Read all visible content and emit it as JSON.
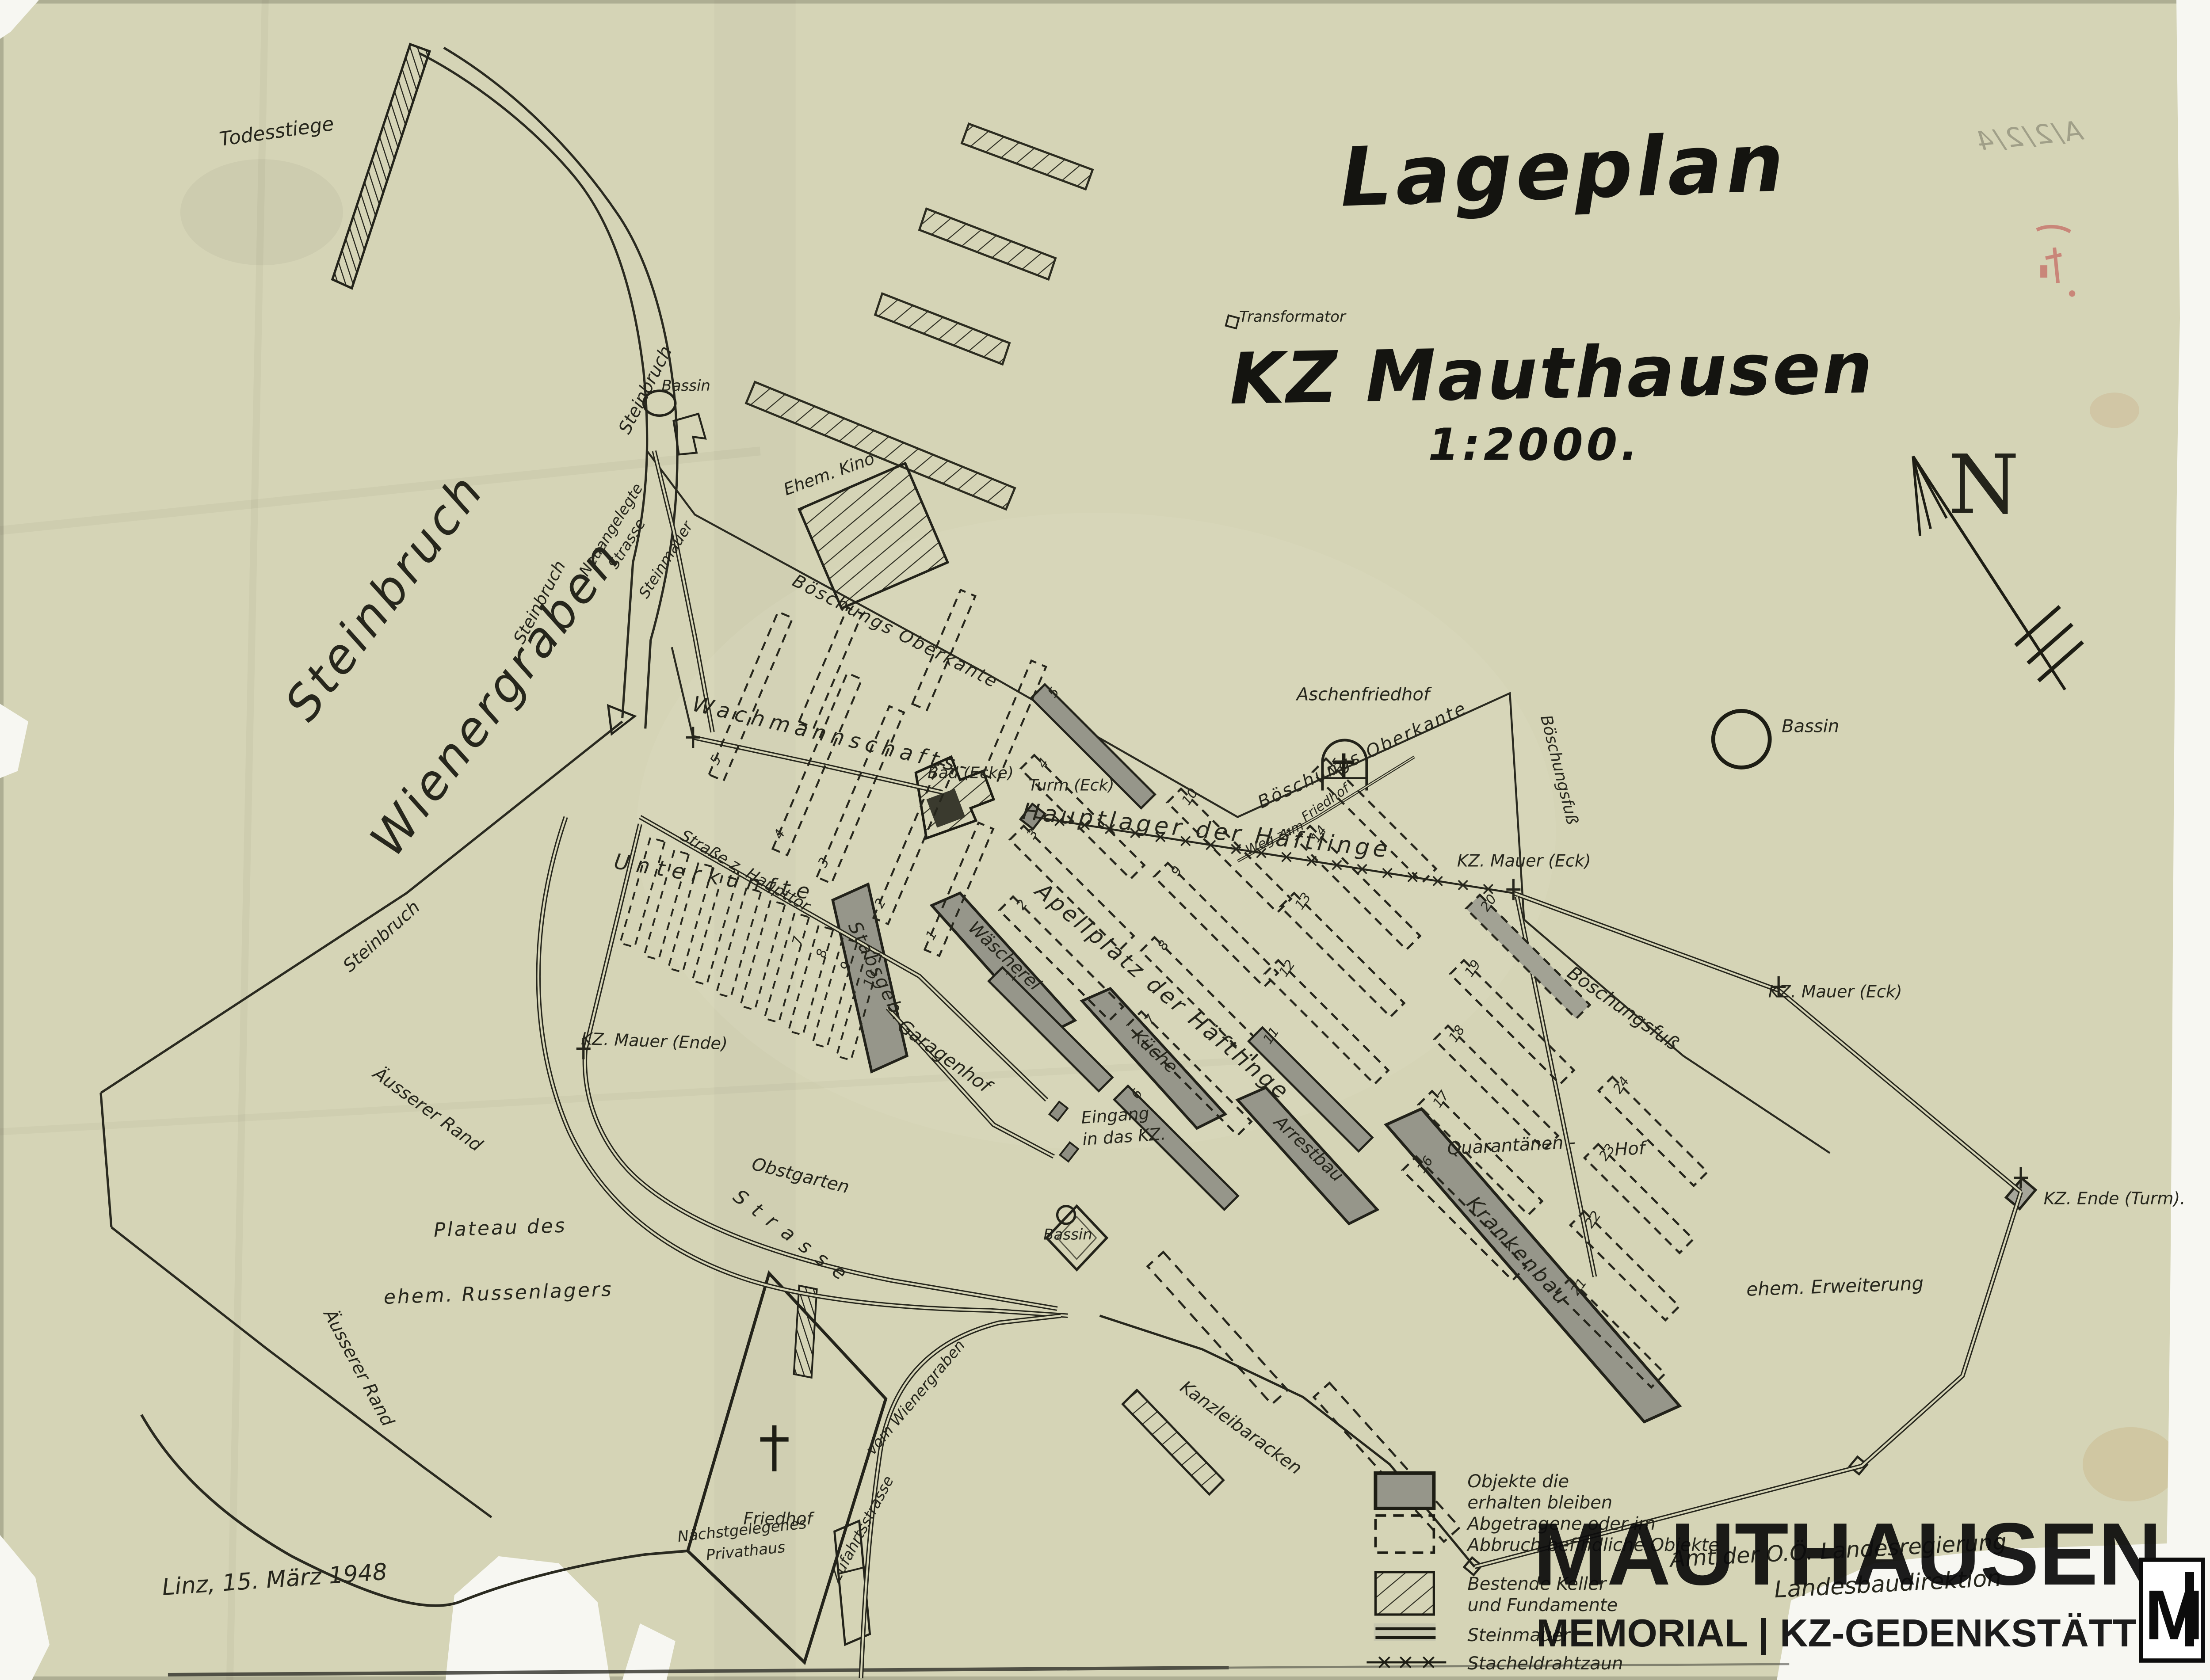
{
  "title": {
    "line1": "Lageplan",
    "line2": "KZ Mauthausen",
    "scale": "1:2000."
  },
  "compass": {
    "label": "N"
  },
  "annotations": {
    "date_note": "Linz, 15. März 1948",
    "archive_mark": "A/2/2/4",
    "stamp_line1": "Amt der O.Ö. Landesregierung",
    "stamp_line2": "Landesbaudirektion"
  },
  "logo": {
    "title": "MAUTHAUSEN",
    "subtitle": "MEMORIAL | KZ-GEDENKSTÄTTE",
    "monogram": "M"
  },
  "legend": {
    "items": [
      {
        "symbol": "solid-block",
        "label_lines": [
          "Objekte die",
          "erhalten bleiben"
        ]
      },
      {
        "symbol": "dashed-block",
        "label_lines": [
          "Abgetragene oder im",
          "Abbruch befindliche Objekte"
        ]
      },
      {
        "symbol": "hatched-block",
        "label_lines": [
          "Bestende Keller",
          "und Fundamente"
        ]
      },
      {
        "symbol": "stone-wall",
        "label_lines": [
          "Steinmauer"
        ]
      },
      {
        "symbol": "barbed-wire",
        "label_lines": [
          "Stacheldrahtzaun"
        ]
      }
    ]
  },
  "barracks": {
    "hauptlager": [
      1,
      2,
      3,
      4,
      5,
      6,
      7,
      8,
      9,
      10,
      11,
      12,
      13,
      14,
      15,
      16,
      17,
      18,
      19,
      20
    ],
    "quarantaene": [
      21,
      22,
      23,
      24
    ],
    "wachmannschaft": [
      1,
      2,
      3,
      4,
      5
    ],
    "unterkuenfte": [
      7,
      8,
      9,
      10
    ]
  },
  "map_labels": {
    "todesstiege": "Todesstiege",
    "steinbruch_road_top": "Steinbruch",
    "steinbruch_road_mid": "Steinbruch",
    "steinbruch_road_low": "Steinbruch",
    "quarry_line1": "Steinbruch",
    "quarry_line2": "Wienergraben",
    "neuangelegte_1": "Neuangelegte",
    "neuangelegte_2": "Strasse",
    "steinmauer": "Steinmauer",
    "bassin_top": "Bassin",
    "transformator": "Transformator",
    "ehem_kino": "Ehem. Kino",
    "boeschungs_oberkante_1": "Böschungs Oberkante",
    "bad_ecke": "Bad (Ecke)",
    "turm_eck": "Turm (Eck)",
    "wachmannschafts": "Wachmannschafts-",
    "strasse_z_haupttor": "Straße z. Haupttor",
    "unterkuenfte": "Unterkünfte",
    "kz_mauer_ende": "KZ. Mauer (Ende)",
    "stabsgeb": "Stabsgeb.",
    "garagenhof": "Garagenhof",
    "obstgarten": "Obstgarten",
    "eingang_1": "Eingang",
    "eingang_2": "in das KZ.",
    "bassin_mid": "Bassin",
    "waescherei": "Wäscherei",
    "kueche": "Küche",
    "arrestbau": "Arrestbau",
    "krankenbau": "Krankenbau",
    "apellplatz": "Apellplatz der Häftlinge",
    "hauptlager": "Hauptlager der Häftlinge",
    "aschenfriedhof": "Aschenfriedhof",
    "weg_zum_1": "Weg zum",
    "weg_zum_2": "Friedhof",
    "boeschungs_oberkante_2": "Böschungs Oberkante",
    "boeschungsfuss_1": "Böschungsfuß",
    "boeschungsfuss_2": "Böschungsfuß",
    "bassin_right": "Bassin",
    "kz_mauer_eck_1": "KZ. Mauer (Eck)",
    "kz_mauer_eck_2": "KZ. Mauer (Eck)",
    "kz_ende_turm": "KZ. Ende (Turm).",
    "quarantaenen": "Quarantänen -",
    "hof": "Hof",
    "ehem_erweiterung": "ehem. Erweiterung",
    "kanzleibaracken": "Kanzleibaracken",
    "strasse_kurve": "Strasse",
    "aeusserer_rand_1": "Äusserer Rand",
    "aeusserer_rand_2": "Äusserer Rand",
    "plateau_1": "Plateau des",
    "plateau_2": "ehem. Russenlagers",
    "friedhof": "Friedhof",
    "zufahrt_1": "Zufahrtsstrasse",
    "zufahrt_2": "vom Wienergraben",
    "privathaus_1": "Nächstgelegenes",
    "privathaus_2": "Privathaus"
  }
}
